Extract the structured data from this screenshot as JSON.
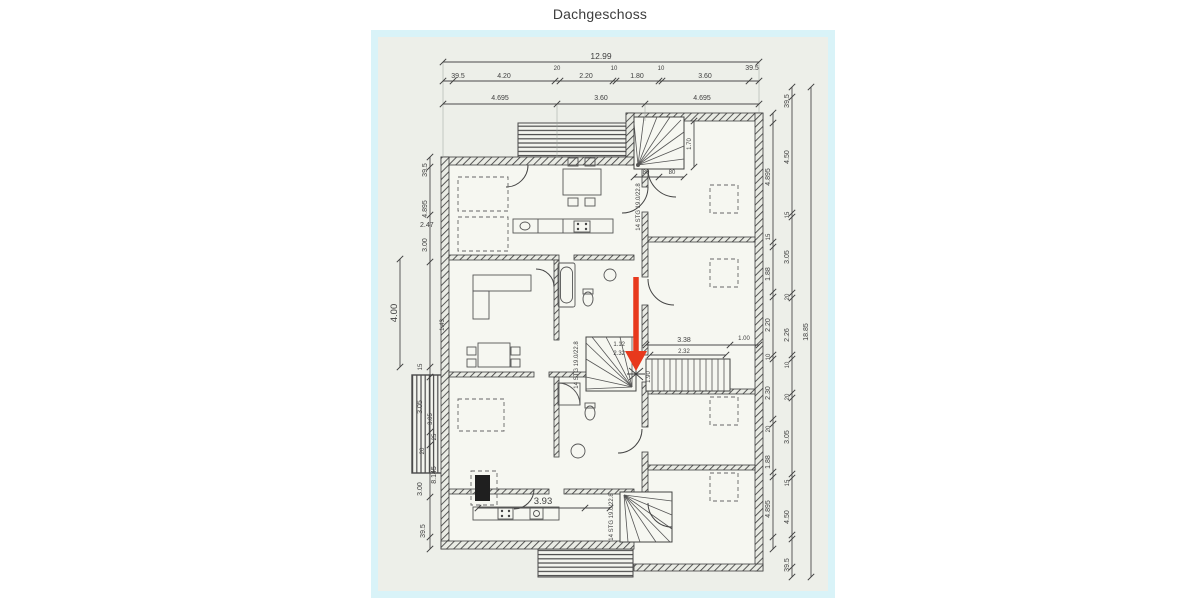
{
  "page": {
    "title": "Dachgeschoss"
  },
  "colors": {
    "paper": "#edefe9",
    "scan_border": "#d9f3f8",
    "ink": "#3f3f3f",
    "arrow_red": "#e8391d"
  },
  "plan": {
    "stair_label": "14 STG 19.0/22.8",
    "dims": {
      "top_total": "12.99",
      "top_row2": [
        "39.5",
        "4.20",
        "20",
        "2.20",
        "10",
        "1.80",
        "10",
        "3.60",
        "39.5"
      ],
      "top_row3": [
        "4.695",
        "3.60",
        "4.695"
      ],
      "right_total": "18.85",
      "right_inner": [
        "4.895",
        "15",
        "1.88",
        "2.20",
        "10",
        "2.30",
        "20",
        "1.88",
        "4.895"
      ],
      "right_outer_chain": [
        "39.5",
        "4.50",
        "15",
        "3.05",
        "20",
        "2.26",
        "10",
        "20",
        "3.05",
        "15",
        "4.50",
        "39.5"
      ],
      "left_chain": [
        "39.5",
        "4.895",
        "3.00",
        "2.47",
        "1.43",
        "3.05",
        "25",
        "15",
        "3.05",
        "20",
        "8.145",
        "3.00",
        "39.5"
      ],
      "left_balcony_width": "4.00",
      "interior": {
        "top_stair_depth": "1.70",
        "top_stair_w1": "80",
        "top_stair_w2": "80",
        "hall_length": "3.38",
        "hall_length2": "2.32",
        "landing": "1.00",
        "arrow_dim1": "1.12",
        "arrow_dim2": "2.32",
        "stair_run": "1.90",
        "kitchen_width": "3.93"
      }
    }
  }
}
